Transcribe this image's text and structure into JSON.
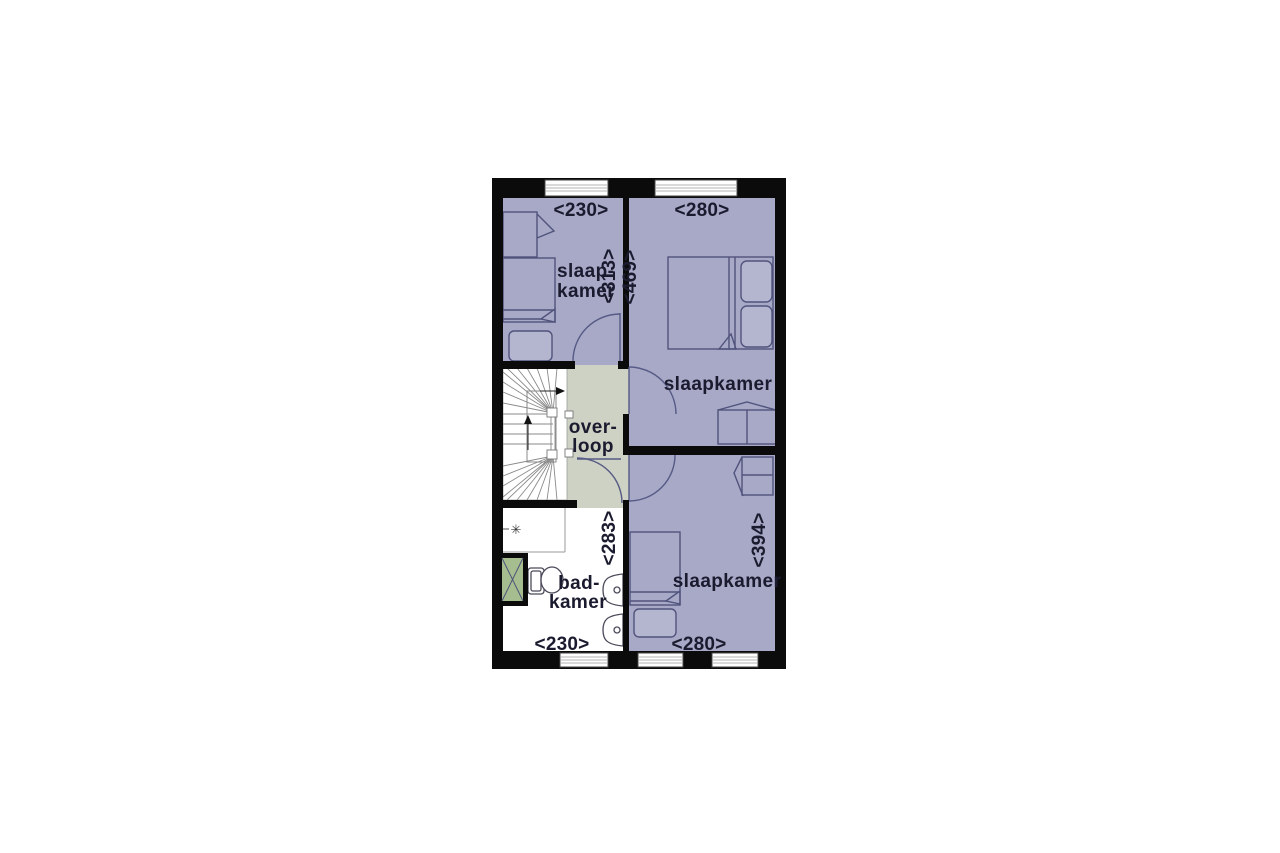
{
  "plan_title": "floorplan-first-floor",
  "rooms": {
    "bedroom_top_left": {
      "label_line1": "slaap-",
      "label_line2": "kamer",
      "width_dim": "<230>",
      "depth_dim": "<313>"
    },
    "bedroom_top_right": {
      "label": "slaapkamer",
      "width_dim": "<280>",
      "depth_dim": "<469>"
    },
    "landing": {
      "label_line1": "over-",
      "label_line2": "loop"
    },
    "bathroom": {
      "label_line1": "bad-",
      "label_line2": "kamer",
      "width_dim": "<230>",
      "depth_dim": "<283>"
    },
    "bedroom_bottom_right": {
      "label": "slaapkamer",
      "width_dim": "<280>",
      "depth_dim": "<394>"
    }
  },
  "symbols": {
    "ventilation": "✳"
  },
  "colors": {
    "room_fill": "#a7a9c7",
    "landing_fill": "#cdd2c4",
    "shower_fill": "#a6bd8f",
    "wall": "#0b0b0b",
    "text": "#1b1b2f",
    "furniture_line": "#50537c"
  }
}
